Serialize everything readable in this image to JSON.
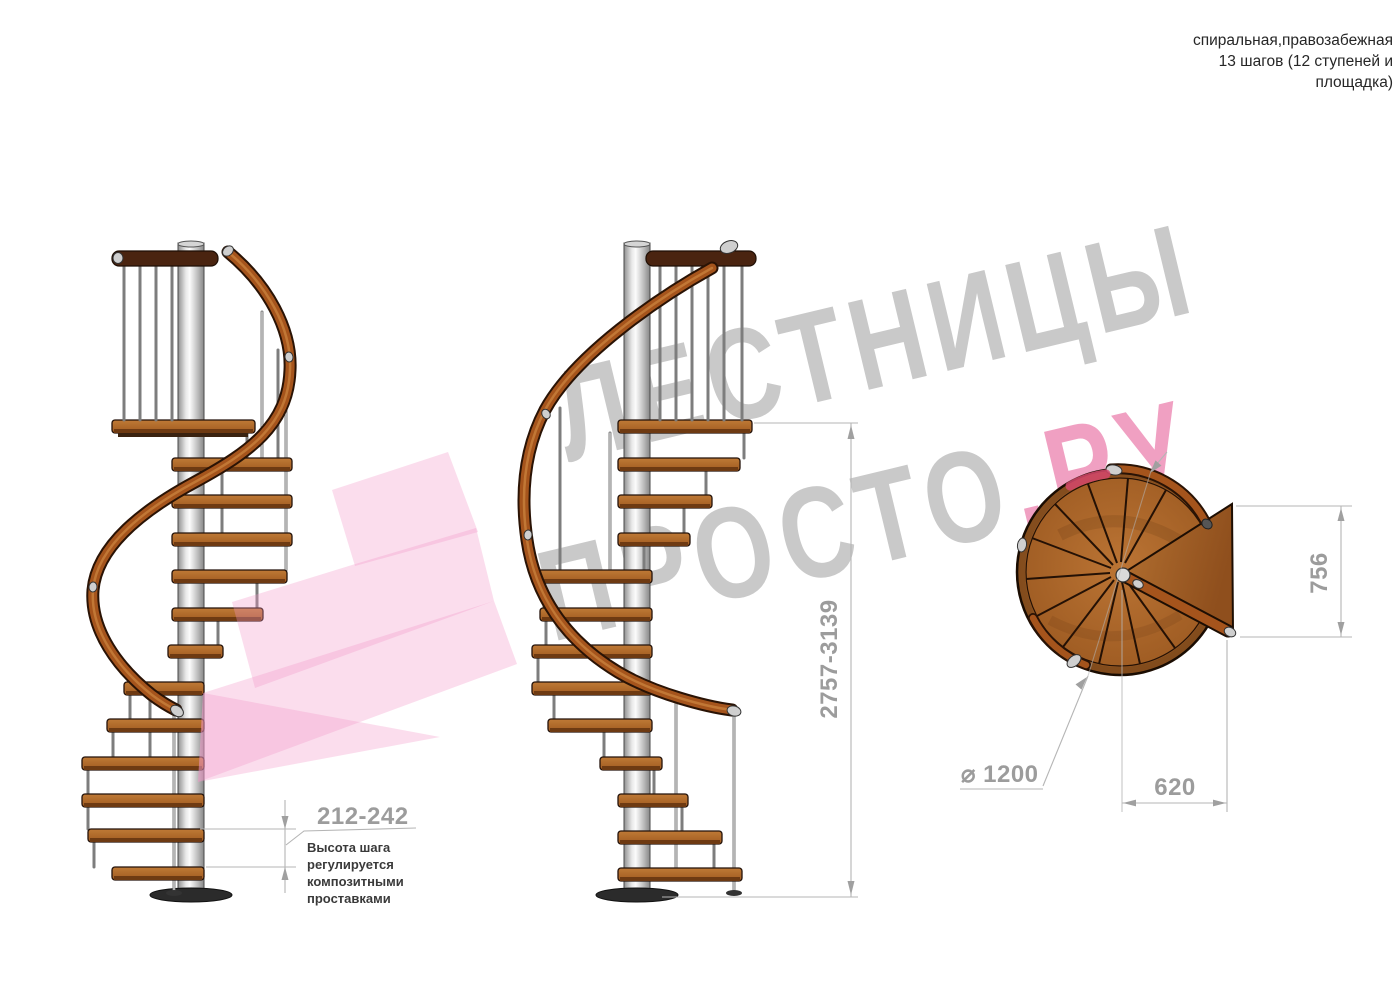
{
  "title_block": {
    "line1": "спиральная,правозабежная",
    "line2": "13 шагов (12 ступеней и",
    "line3": "площадка)"
  },
  "watermark": {
    "word1": "ЛЕСТНИЦЫ",
    "word2": "ПРОСТО",
    "word2_suffix": ".РУ"
  },
  "dimensions": {
    "step_height": "212-242",
    "total_height": "2757-3139",
    "landing_side": "756",
    "diameter": "⌀ 1200",
    "landing_width": "620"
  },
  "note": {
    "line1": "Высота шага",
    "line2": "регулируется",
    "line3": "композитными",
    "line4": "проставками"
  },
  "colors": {
    "wood": "#a9622a",
    "wood_dark": "#7c4212",
    "rail": "#a5541c",
    "metal": "#c9c9c9",
    "watermark_gray": "#c9c9c9",
    "watermark_pink": "#f0a0c2",
    "logo_pink": "#f299c7",
    "dim_text": "#9c9c9c",
    "dim_line": "#b5b5b5",
    "ink": "#262626",
    "accent_red": "#d5486b"
  }
}
